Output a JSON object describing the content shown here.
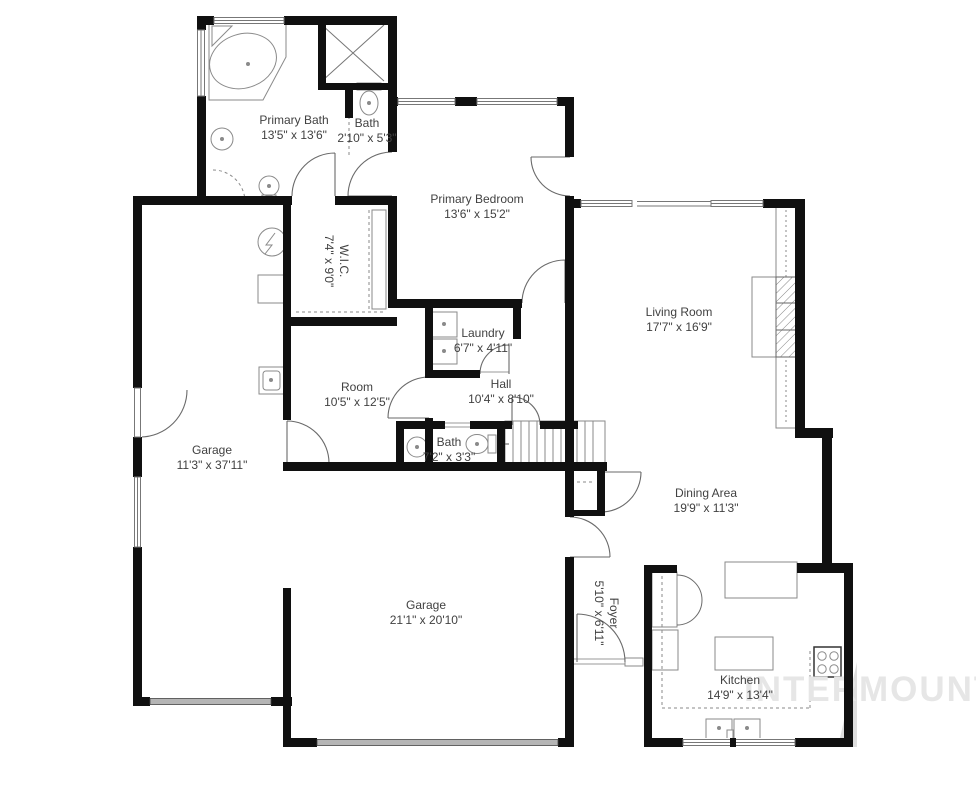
{
  "watermark": {
    "text": "INTERMOUNTAIN",
    "color": "#e6e6e6"
  },
  "colors": {
    "wall": "#101010",
    "fixture_line": "#8a8a8a",
    "door_line": "#6a6a6a",
    "label_text": "#414141"
  },
  "rooms": [
    {
      "name": "Primary Bath",
      "dims": "13'5\" x 13'6\""
    },
    {
      "name": "Bath",
      "dims": "2'10\" x 5'3\""
    },
    {
      "name": "Primary Bedroom",
      "dims": "13'6\" x 15'2\""
    },
    {
      "name": "W.I.C.",
      "dims": "7'4\" x 9'0\""
    },
    {
      "name": "Living Room",
      "dims": "17'7\" x 16'9\""
    },
    {
      "name": "Laundry",
      "dims": "6'7\" x 4'11\""
    },
    {
      "name": "Room",
      "dims": "10'5\" x 12'5\""
    },
    {
      "name": "Hall",
      "dims": "10'4\" x 8'10\""
    },
    {
      "name": "Bath",
      "dims": "7'2\" x 3'3\""
    },
    {
      "name": "Garage",
      "dims": "11'3\" x 37'11\""
    },
    {
      "name": "Dining Area",
      "dims": "19'9\" x 11'3\""
    },
    {
      "name": "Garage",
      "dims": "21'1\" x 20'10\""
    },
    {
      "name": "Foyer",
      "dims": "5'10\" x 6'11\""
    },
    {
      "name": "Kitchen",
      "dims": "14'9\" x 13'4\""
    }
  ]
}
